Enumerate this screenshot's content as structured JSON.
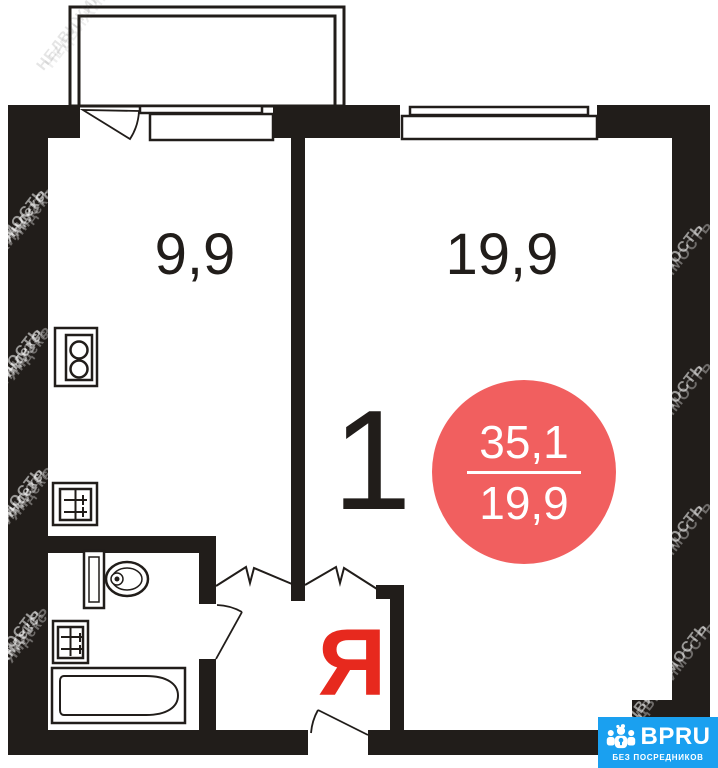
{
  "plan": {
    "kitchen_area_label": "9,9",
    "room_area_label": "19,9",
    "room_count": "1",
    "hall_letter": "Я",
    "summary_badge": {
      "total_area": "35,1",
      "living_area": "19,9"
    }
  },
  "watermark": {
    "brand": "Яндекс",
    "word": "НЕДВИЖИМОСТЬ"
  },
  "badge": {
    "name": "BPRU",
    "tagline": "БЕЗ ПОСРЕДНИКОВ"
  },
  "colors": {
    "wall_black": "#211d1a",
    "area_circle_red": "#f15f5f",
    "yandex_letter_red": "#e7291e",
    "bpru_blue": "#1aa0f0"
  }
}
